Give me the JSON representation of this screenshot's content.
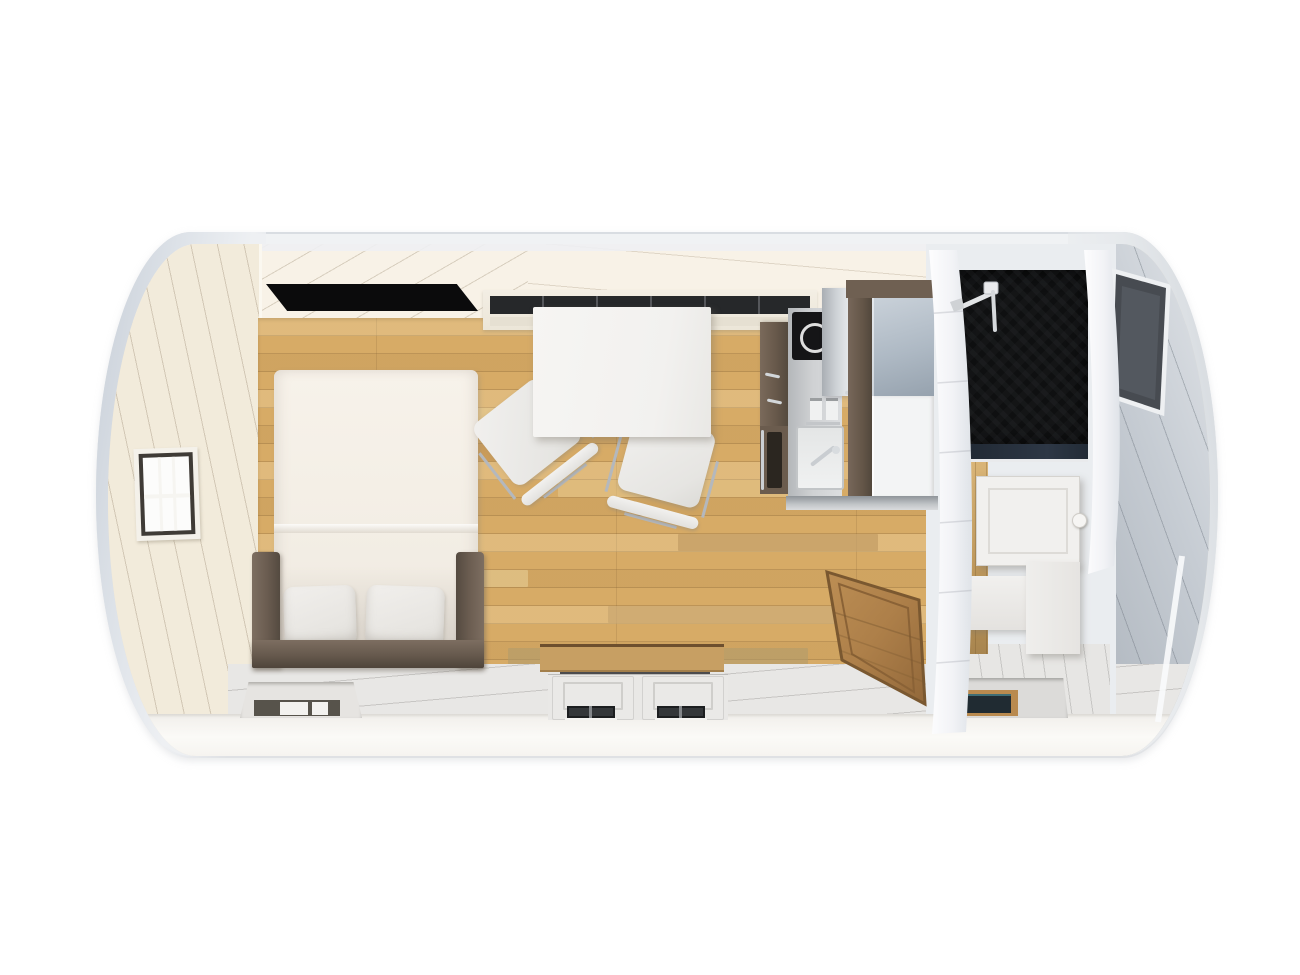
{
  "scene": {
    "label": "Top-down 3D rendering of a barrel-style tiny house (camping pod) interior",
    "rooms": {
      "living": {
        "label": "Living and sleeping area with wood floor"
      },
      "bathroom": {
        "label": "Bathroom with black slate shower"
      }
    }
  },
  "palette": {
    "background": "#ffffff",
    "shell_light": "#eef0f3",
    "shell_shadow": "#c7ced7",
    "ceiling_cream": "#f8f2e7",
    "end_wall_cream": "#f2ebdb",
    "wood_floor": "#d7ab66",
    "wood_floor_dark": "#c0955a",
    "wood_floor_light": "#ecd9a6",
    "near_wall_white": "#e8e7e5",
    "bright_band": "#f7f5f2",
    "bed_frame_brown": "#6a5c50",
    "mattress_white": "#f4efe7",
    "pillow_grey": "#eceae7",
    "table_white": "#f5f4f2",
    "chair_white": "#ebeae8",
    "chrome": "#c9cdd2",
    "kitchen_brown": "#6b5c4e",
    "cooktop_black": "#151517",
    "counter_grey": "#c6c9cc",
    "cabinet_glass_grey": "#aeb9c4",
    "shower_black": "#0f1011",
    "partition_white": "#f3f4f6",
    "end_wall_grey": "#ccd1d7",
    "window_dark": "#484c52",
    "door_wood": "#ad7f49",
    "glazing_dark": "#26282a"
  },
  "objects": {
    "pod": {
      "label": "Barrel-shaped pod shell"
    },
    "bed": {
      "label": "Double bed with brown frame"
    },
    "pillow": {
      "label": "Pillow"
    },
    "skylight": {
      "label": "Roof skylight window"
    },
    "end_window_left": {
      "label": "End-wall window with muntin bars"
    },
    "clerestory_window": {
      "label": "Long high window above dining area"
    },
    "dining_table": {
      "label": "White dining table"
    },
    "chair": {
      "label": "White chair"
    },
    "kitchenette": {
      "label": "Kitchenette"
    },
    "cooktop": {
      "label": "Cooktop with burner ring"
    },
    "sink": {
      "label": "Kitchen sink with faucet"
    },
    "oven": {
      "label": "Built-in oven"
    },
    "tall_cabinet": {
      "label": "Tall cabinet / fridge unit"
    },
    "bathroom_door": {
      "label": "Wooden bathroom door"
    },
    "partition": {
      "label": "Curved partition wall"
    },
    "shower": {
      "label": "Shower with black slate tiles"
    },
    "shower_fixture": {
      "label": "Shower head and rail"
    },
    "mirror_cabinet": {
      "label": "Bathroom wall cabinet"
    },
    "vanity": {
      "label": "Washbasin unit"
    },
    "toilet": {
      "label": "Toilet unit"
    },
    "entry_doors": {
      "label": "Double entry doors in front wall"
    },
    "front_window": {
      "label": "Front-wall recessed window"
    },
    "bathroom_window": {
      "label": "Bathroom front window"
    },
    "end_window_right": {
      "label": "Rear end window"
    },
    "vent": {
      "label": "Outer wall vent"
    }
  }
}
